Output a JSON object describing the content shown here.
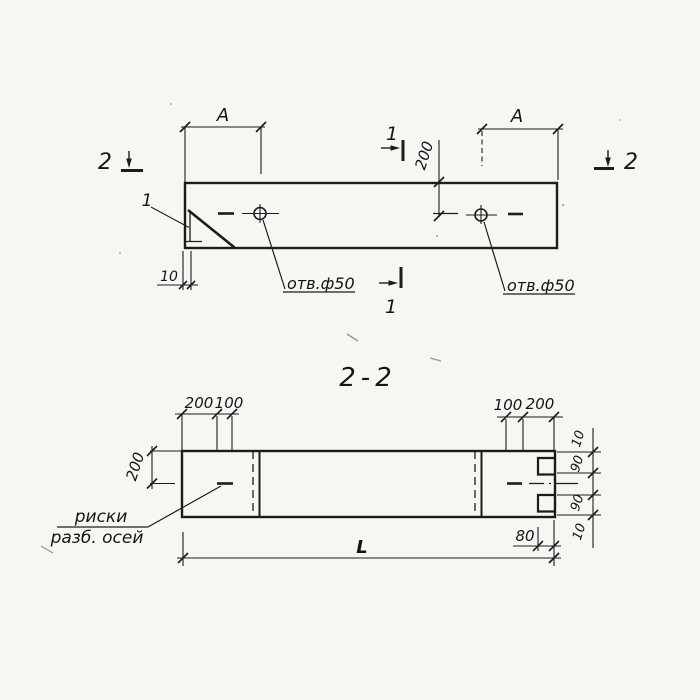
{
  "colors": {
    "paper": "#f7f6f2",
    "ink": "#1c1c1c"
  },
  "top_view": {
    "dim_a_left": "А",
    "dim_a_right": "А",
    "dim_hole_offset": "200",
    "dim_edge": "10",
    "hole_left_label": "отв.ф50",
    "hole_right_label": "отв.ф50",
    "detail_label": "1",
    "marker_2_left": "2",
    "marker_2_right": "2",
    "marker_1_top": "1",
    "marker_1_bottom": "1"
  },
  "section": {
    "title": "2-2",
    "dim_left_outer": "200",
    "dim_left_inner": "100",
    "dim_right_inner": "100",
    "dim_right_outer": "200",
    "dim_height": "200",
    "chain": [
      "10",
      "90",
      "90",
      "10"
    ],
    "dim_notch": "80",
    "dim_length": "L",
    "axis_note_line1": "риски",
    "axis_note_line2": "разб. осей"
  }
}
